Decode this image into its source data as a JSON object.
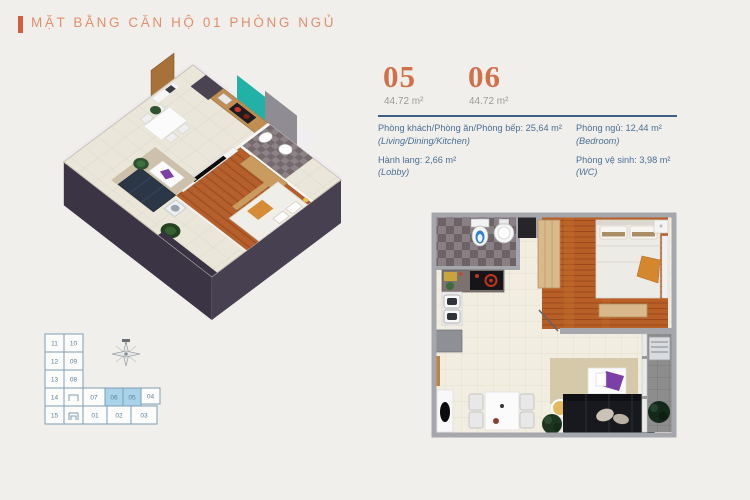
{
  "colors": {
    "bg": "#f0efec",
    "accent": "#cf6040",
    "accent-light": "#e18f6d",
    "number-orange": "#d0714c",
    "area-gray": "#9b9b9b",
    "text-blue": "#4b6e92",
    "divider-blue": "#3e5f83",
    "keyplan-line": "#7f9db5",
    "keyplan-text": "#5d7f9a",
    "keyplan-highlight": "#a9d3e9"
  },
  "header": {
    "title": "MẶT BẰNG CĂN HỘ 01 PHÒNG NGỦ"
  },
  "units": [
    {
      "number": "05",
      "area": "44.72 m²"
    },
    {
      "number": "06",
      "area": "44.72 m²"
    }
  ],
  "room_details": {
    "col1": [
      {
        "label": "Phòng khách/Phòng ăn/Phòng bếp: 25,64 m²",
        "sub": "(Living/Dining/Kitchen)"
      },
      {
        "label": "Hành lang: 2,66 m²",
        "sub": "(Lobby)"
      }
    ],
    "col2": [
      {
        "label": "Phòng ngủ: 12,44 m²",
        "sub": "(Bedroom)"
      },
      {
        "label": "Phòng vệ sinh: 3,98 m²",
        "sub": "(WC)"
      }
    ]
  },
  "keyplan": {
    "units": [
      "11",
      "10",
      "12",
      "09",
      "13",
      "08",
      "14",
      "15",
      "07",
      "06",
      "05",
      "04",
      "01",
      "02",
      "03"
    ],
    "highlighted_units": "05, 06",
    "compass_icon": "compass-rose"
  }
}
